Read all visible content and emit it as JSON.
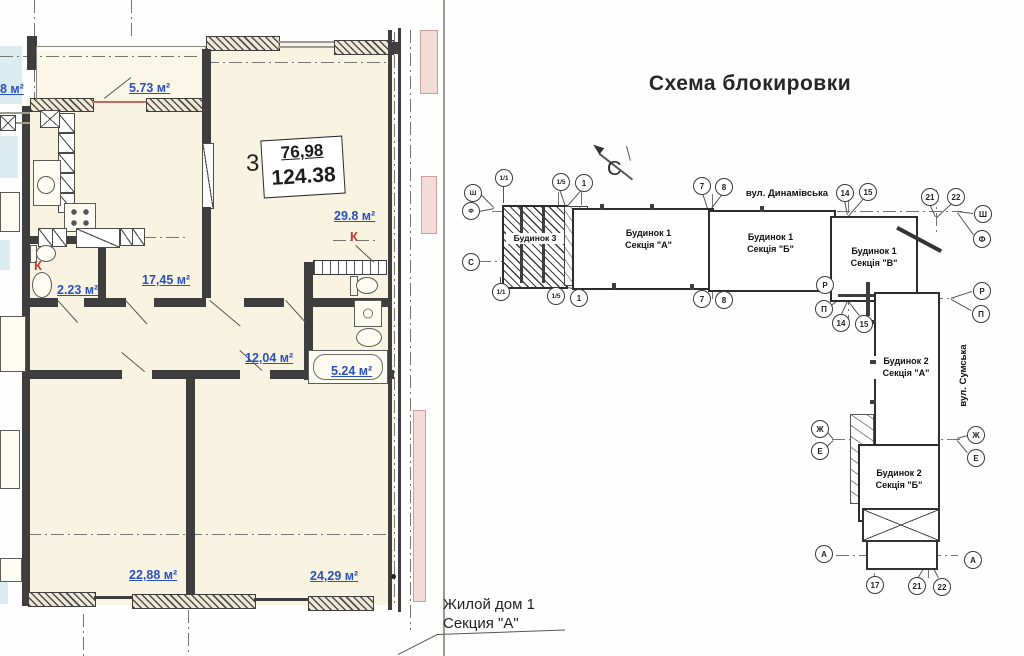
{
  "plan": {
    "box": {
      "count": "3",
      "top": "76,98",
      "bottom": "124.38"
    },
    "rooms": [
      {
        "name": "balcony",
        "area": "5.73 м²"
      },
      {
        "name": "kitchen",
        "area": "17,45 м²"
      },
      {
        "name": "wc",
        "area": "2.23 м²"
      },
      {
        "name": "living-room",
        "area": "29.8 м²"
      },
      {
        "name": "hallway",
        "area": "12,04 м²"
      },
      {
        "name": "bathroom",
        "area": "5.24 м²"
      },
      {
        "name": "bedroom-1",
        "area": "22,88 м²"
      },
      {
        "name": "bedroom-2",
        "area": "24,29 м²"
      },
      {
        "name": "adjacent-room-partial",
        "area": "8 м²"
      }
    ],
    "k_label": "К",
    "caption": {
      "line1": "Жилой дом 1",
      "line2": "Секция \"А\""
    }
  },
  "scheme": {
    "title": "Схема блокировки",
    "north": "С",
    "streets": [
      "вул. Динамівська",
      "вул. Сумська"
    ],
    "blocks": [
      {
        "label": "Будинок 3",
        "sub": ""
      },
      {
        "label": "Будинок 1",
        "sub": "Секція \"А\""
      },
      {
        "label": "Будинок 1",
        "sub": "Секція \"Б\""
      },
      {
        "label": "Будинок 1",
        "sub": "Секція \"В\""
      },
      {
        "label": "Будинок 2",
        "sub": "Секція \"А\""
      },
      {
        "label": "Будинок 2",
        "sub": "Секція \"Б\""
      }
    ],
    "markers": [
      "Ш",
      "Ф",
      "1/1",
      "1/5",
      "1",
      "С",
      "1/1",
      "1/5",
      "1",
      "7",
      "8",
      "7",
      "8",
      "14",
      "15",
      "21",
      "22",
      "Ш",
      "Ф",
      "Р",
      "П",
      "Р",
      "П",
      "14",
      "15",
      "Ж",
      "Е",
      "Ж",
      "Е",
      "А",
      "А",
      "17",
      "21",
      "22"
    ]
  },
  "colors": {
    "area_label": "#2a50c0",
    "k_marker": "#c03a2e",
    "wall": "#3e3e3e",
    "plan_fill": "#f9f4e2",
    "neighbor_fill": "#dcedf2",
    "balcony_pink": "#f3dbd8"
  }
}
